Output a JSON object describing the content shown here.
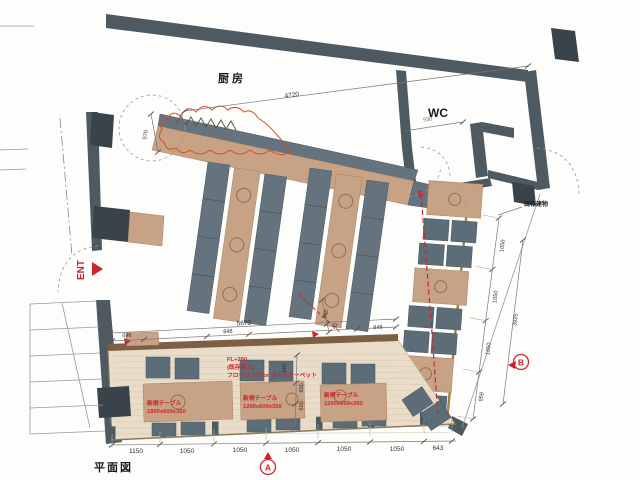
{
  "meta": {
    "drawing_label": "平面図"
  },
  "colors": {
    "wall": "#4e5a61",
    "wall_dark": "#39444a",
    "wood": "#c8a285",
    "bench": "#64737e",
    "seat": "#5d6d78",
    "floor": "#e9ddc9",
    "edge_brown": "#7d5f43",
    "accent_red": "#c9252b",
    "cloud_red": "#d4502a",
    "dim_green": "#5a7a50"
  },
  "rooms": {
    "kitchen": "厨房",
    "wc": "WC",
    "entrance": "ENT"
  },
  "section_markers": {
    "a": "A",
    "b": "B"
  },
  "notes": {
    "existing_building": "既存建物",
    "floor_level": "FL+250",
    "floor_base": "(既存床上)",
    "floor_finish": "フローリング or タイルカーペット"
  },
  "tables": [
    {
      "name": "新規テーブル",
      "size": "1800x600x350"
    },
    {
      "name": "新規テーブル",
      "size": "1200x600x350"
    },
    {
      "name": "新規テーブル",
      "size": "1200x600x350"
    }
  ],
  "dims": {
    "kitchen_width": "4720",
    "kitchen_depth": "570",
    "wc_width": "930",
    "hall_width": "5673",
    "hall_left": "646",
    "hall_mid": "848",
    "hall_right": "848",
    "step_a": "450",
    "step_b": "92",
    "table_depth_a": "600",
    "table_depth_b": "600",
    "table_depth_c": "600",
    "bottom_row": [
      "1150",
      "1050",
      "1050",
      "1050",
      "1050",
      "1050",
      "643"
    ],
    "right_row": [
      "1050",
      "1050",
      "1050",
      "959"
    ],
    "right_total": "3925"
  }
}
